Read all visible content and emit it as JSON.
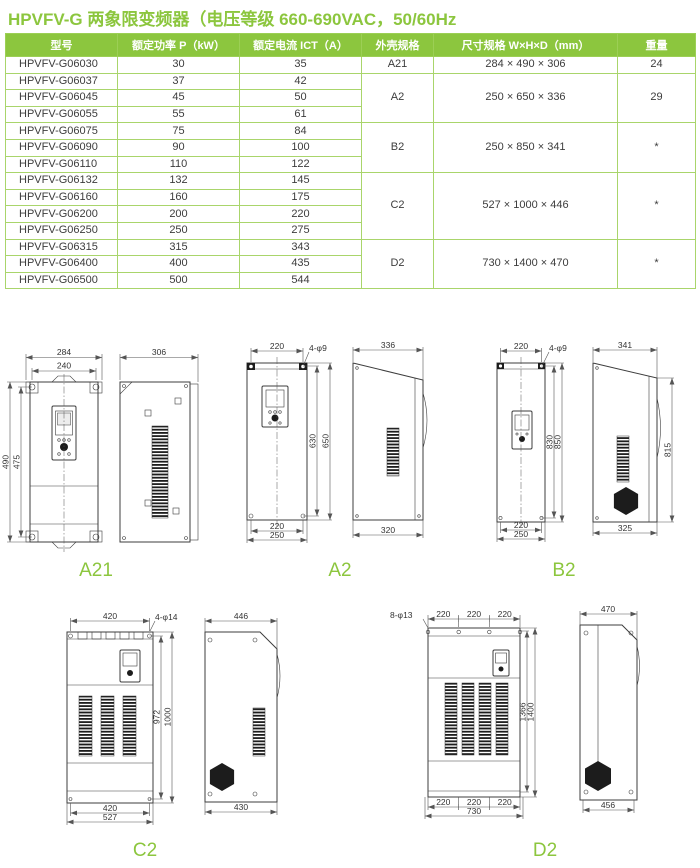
{
  "page": {
    "title": "HPVFV-G 两象限变频器（电压等级 660-690VAC，50/60Hz",
    "accent_color": "#8CC63E"
  },
  "table": {
    "headers": {
      "model": "型号",
      "power": "额定功率 P（kW）",
      "current": "额定电流 ICT（A）",
      "frame": "外壳规格",
      "size": "尺寸规格 W×H×D（mm）",
      "weight": "重量"
    },
    "rows": [
      {
        "model": "HPVFV-G06030",
        "power": "30",
        "current": "35"
      },
      {
        "model": "HPVFV-G06037",
        "power": "37",
        "current": "42"
      },
      {
        "model": "HPVFV-G06045",
        "power": "45",
        "current": "50"
      },
      {
        "model": "HPVFV-G06055",
        "power": "55",
        "current": "61"
      },
      {
        "model": "HPVFV-G06075",
        "power": "75",
        "current": "84"
      },
      {
        "model": "HPVFV-G06090",
        "power": "90",
        "current": "100"
      },
      {
        "model": "HPVFV-G06110",
        "power": "110",
        "current": "122"
      },
      {
        "model": "HPVFV-G06132",
        "power": "132",
        "current": "145"
      },
      {
        "model": "HPVFV-G06160",
        "power": "160",
        "current": "175"
      },
      {
        "model": "HPVFV-G06200",
        "power": "200",
        "current": "220"
      },
      {
        "model": "HPVFV-G06250",
        "power": "250",
        "current": "275"
      },
      {
        "model": "HPVFV-G06315",
        "power": "315",
        "current": "343"
      },
      {
        "model": "HPVFV-G06400",
        "power": "400",
        "current": "435"
      },
      {
        "model": "HPVFV-G06500",
        "power": "500",
        "current": "544"
      }
    ],
    "groups": [
      {
        "frame": "A21",
        "size": "284 × 490 × 306",
        "weight": "24"
      },
      {
        "frame": "A2",
        "size": "250 × 650 × 336",
        "weight": "29"
      },
      {
        "frame": "B2",
        "size": "250 × 850 × 341",
        "weight": "*"
      },
      {
        "frame": "C2",
        "size": "527 × 1000 × 446",
        "weight": "*"
      },
      {
        "frame": "D2",
        "size": "730 × 1400 × 470",
        "weight": "*"
      }
    ]
  },
  "drawings": {
    "a21": {
      "label": "A21",
      "front_top_outer": "284",
      "front_top_inner": "240",
      "front_left_outer": "490",
      "front_left_inner": "475",
      "side_top": "306"
    },
    "a2": {
      "label": "A2",
      "front_top": "220",
      "holes": "4-φ9",
      "front_right_inner": "630",
      "front_right_outer": "650",
      "front_bottom_inner": "220",
      "front_bottom_outer": "250",
      "side_top": "336",
      "side_bottom": "320"
    },
    "b2": {
      "label": "B2",
      "front_top": "220",
      "holes": "4-φ9",
      "front_right_inner": "830",
      "front_right_outer": "850",
      "front_bottom_inner": "220",
      "front_bottom_outer": "250",
      "side_top": "341",
      "side_right": "815",
      "side_bottom": "325"
    },
    "c2": {
      "label": "C2",
      "front_top": "420",
      "holes": "4-φ14",
      "front_right_inner": "972",
      "front_right_outer": "1000",
      "front_bottom_inner": "420",
      "front_bottom_outer": "527",
      "side_top": "446",
      "side_bottom": "430"
    },
    "d2": {
      "label": "D2",
      "holes": "8-φ13",
      "front_top_segs": [
        "220",
        "220",
        "220"
      ],
      "front_right_inner": "1366",
      "front_right_outer": "1400",
      "front_bottom_segs": [
        "220",
        "220",
        "220"
      ],
      "front_bottom_total": "730",
      "side_top": "470",
      "side_bottom": "456"
    }
  }
}
